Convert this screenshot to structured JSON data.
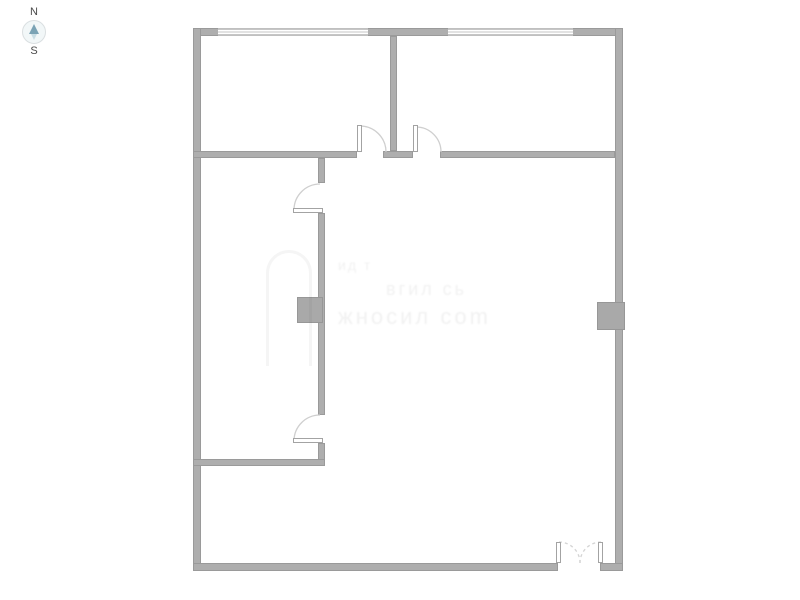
{
  "compass": {
    "north_label": "N",
    "south_label": "S"
  },
  "watermark": {
    "line1": "ид  т",
    "line2": "вгил  сь",
    "line3": "жносил  com"
  },
  "colors": {
    "wall": "#aeaeae",
    "wall_edge": "#9a9a9a",
    "window_stripe": "#c6c6c6",
    "door_arc": "#cfcfcf",
    "pillar": "#a9a9a9",
    "compass_needle": "#7ba3b5",
    "compass_text": "#4a4a4a",
    "background": "#ffffff"
  }
}
